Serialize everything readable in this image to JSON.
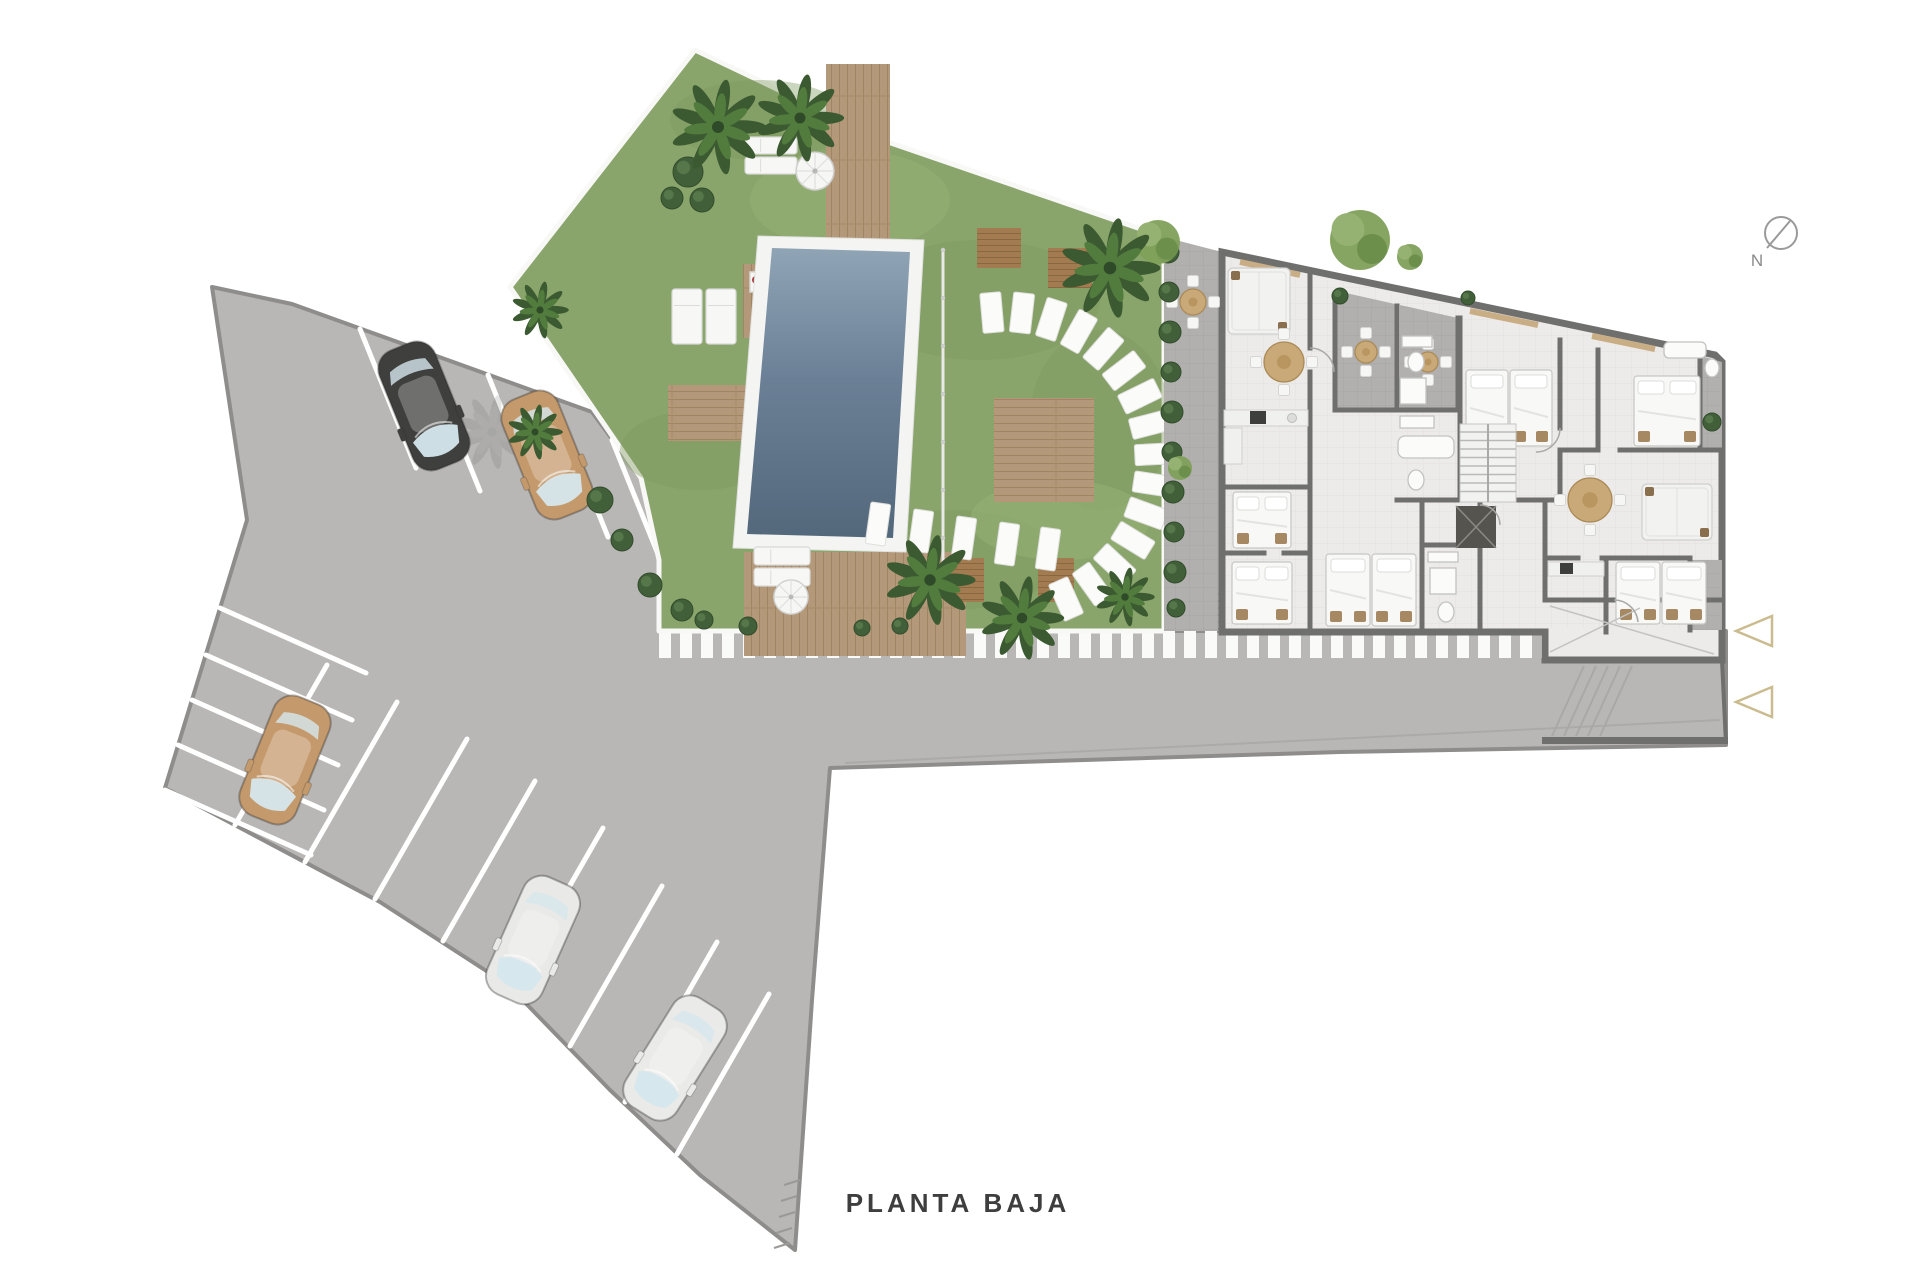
{
  "labels": {
    "plan_caption": "PLANTA BAJA",
    "north": "N"
  },
  "palette": {
    "pavement": "#b8b7b5",
    "pavement_edge": "#8e8d8b",
    "road_mark": "#a9a8a6",
    "wall": "#6f6f6e",
    "floor": "#ecebe9",
    "terrace": "#b1b0ae",
    "grass": "#8aa56b",
    "grass_shade": "#7d9960",
    "pool_light": "#8fa4b5",
    "pool_dark": "#54687c",
    "pool_surround": "#f4f4f2",
    "wood": "#b3987a",
    "wood_dark": "#a27c50",
    "hedge": "#41603a",
    "tree": "#7fa05a",
    "stripe": "#fafaf8",
    "window_accent": "#c9ad85",
    "arrow_outline": "#cbbc90",
    "caption_color": "#3e3e3e",
    "compass_color": "#9a9a9a"
  },
  "cars": [
    {
      "name": "black-car",
      "color": "#3f3f3d"
    },
    {
      "name": "tan-car",
      "color": "#c49a6c"
    },
    {
      "name": "tan-car",
      "color": "#c49a6c"
    },
    {
      "name": "white-car",
      "color": "#e9e9e7"
    },
    {
      "name": "white-car",
      "color": "#eaeae8"
    }
  ]
}
